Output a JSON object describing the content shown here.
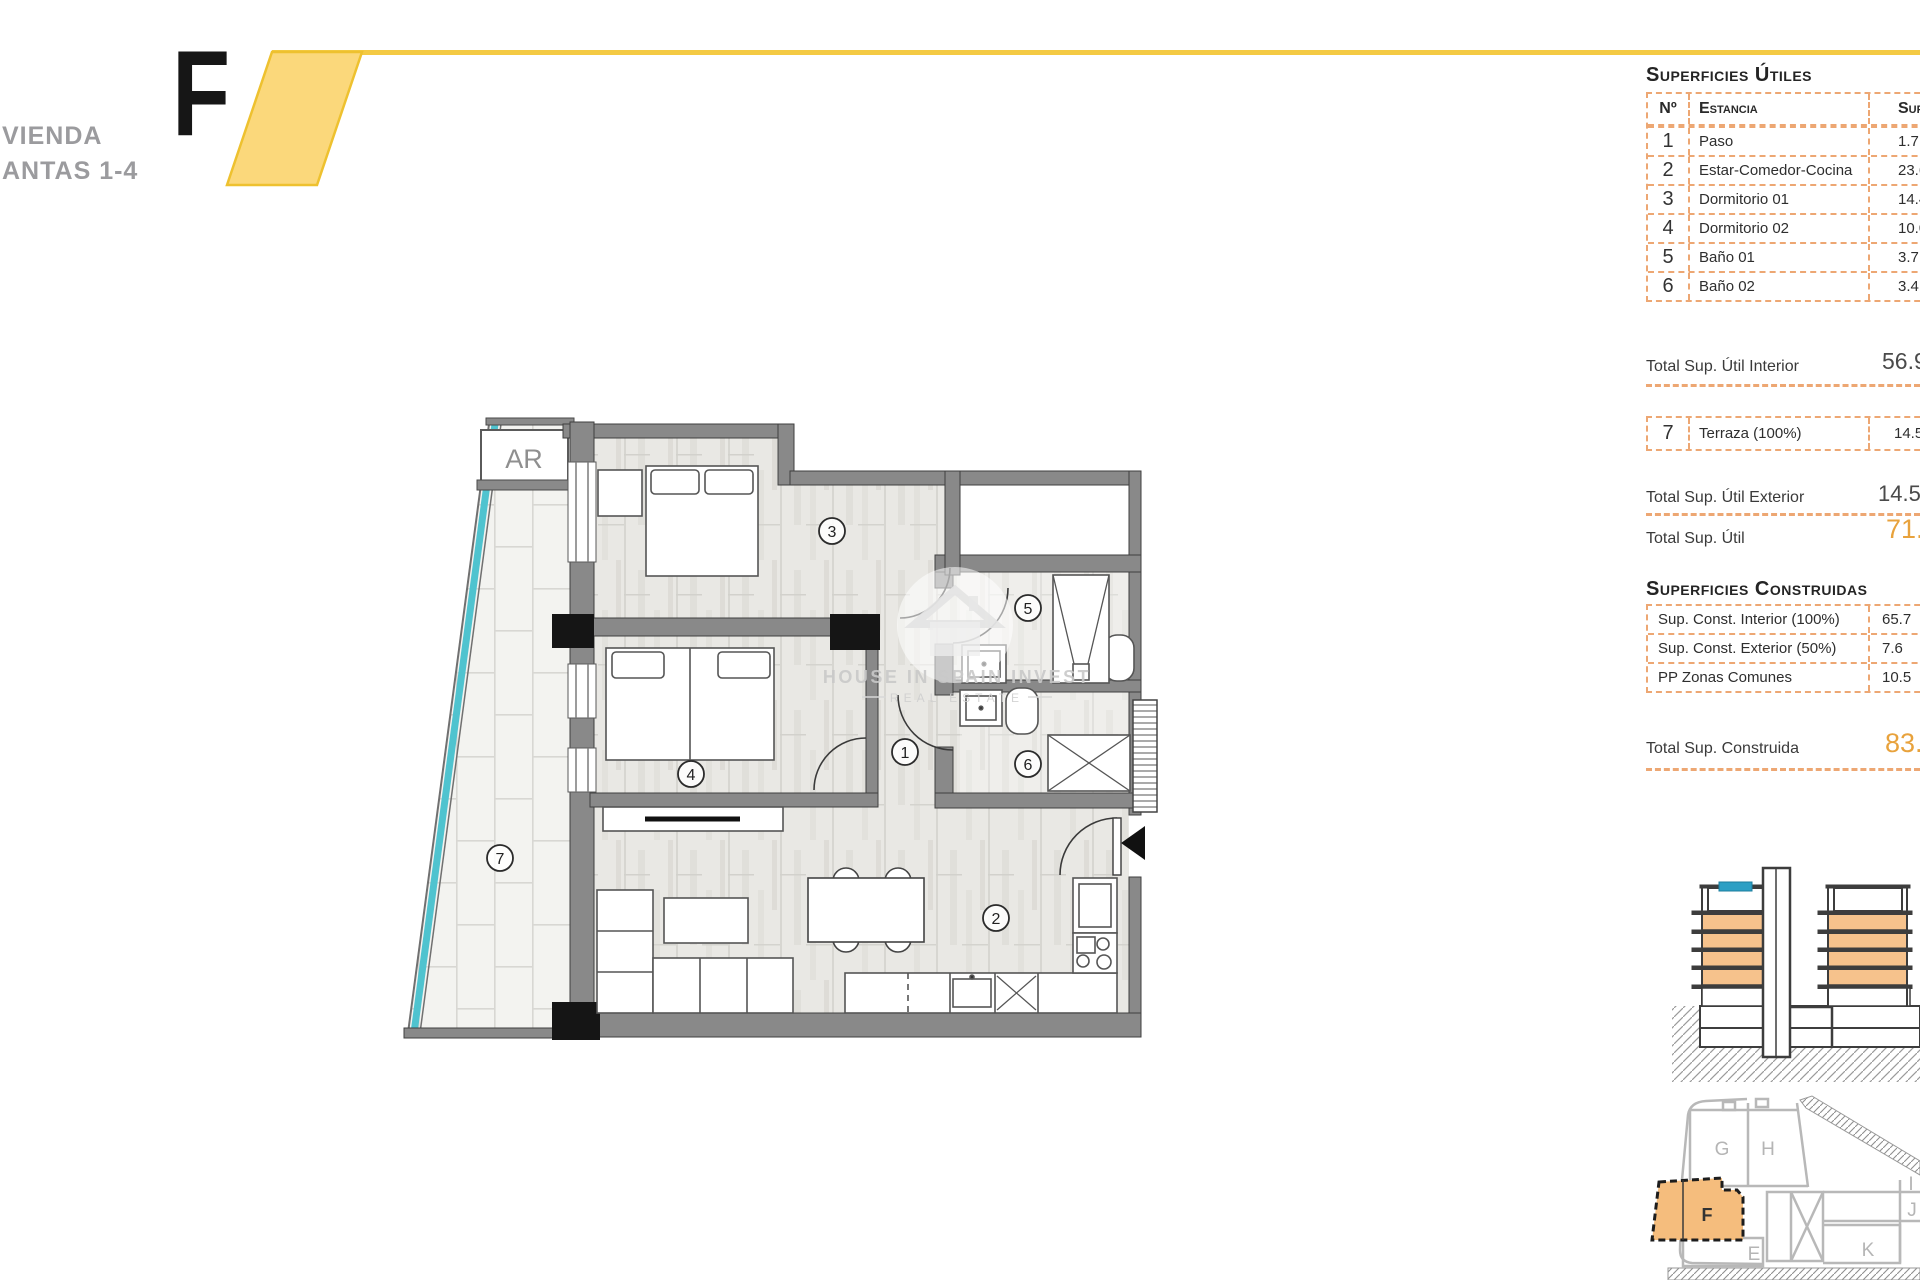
{
  "header": {
    "title_line1": "VIENDA",
    "title_line2": "ANTAS 1-4",
    "unit_letter": "F"
  },
  "colors": {
    "ribbon_yellow": "#fbd87b",
    "ribbon_outline": "#eec12f",
    "table_border_orange": "#eda773",
    "accent_orange_text": "#e8a23c",
    "wall_gray": "#898989",
    "glass_cyan": "#4fc3cf",
    "section_floor_orange": "#f6c28c",
    "site_unit_orange": "#f5bd7d"
  },
  "superficies_utiles": {
    "heading": "Superficies Útiles",
    "col_n": "Nº",
    "col_estancia": "Estancia",
    "col_sup": "Sup.",
    "rows": [
      {
        "n": "1",
        "name": "Paso",
        "value": "1.7"
      },
      {
        "n": "2",
        "name": "Estar-Comedor-Cocina",
        "value": "23.6"
      },
      {
        "n": "3",
        "name": "Dormitorio 01",
        "value": "14.4"
      },
      {
        "n": "4",
        "name": "Dormitorio 02",
        "value": "10.0"
      },
      {
        "n": "5",
        "name": "Baño 01",
        "value": "3.7"
      },
      {
        "n": "6",
        "name": "Baño 02",
        "value": "3.4"
      }
    ],
    "total_interior_label": "Total Sup. Útil Interior",
    "total_interior_value": "56.9",
    "terraza_row": {
      "n": "7",
      "name": "Terraza (100%)",
      "value": "14.5"
    },
    "total_exterior_label": "Total Sup. Útil Exterior",
    "total_exterior_value": "14.5",
    "total_util_label": "Total Sup. Útil",
    "total_util_value": "71."
  },
  "superficies_construidas": {
    "heading": "Superficies Construidas",
    "rows": [
      {
        "name": "Sup. Const. Interior (100%)",
        "value": "65.7"
      },
      {
        "name": "Sup. Const. Exterior (50%)",
        "value": "7.6"
      },
      {
        "name": "PP Zonas Comunes",
        "value": "10.5"
      }
    ],
    "total_label": "Total Sup. Construida",
    "total_value": "83."
  },
  "floor_plan": {
    "storage_label": "AR",
    "rooms": {
      "paso": "1",
      "estar": "2",
      "dorm1": "3",
      "dorm2": "4",
      "bano1": "5",
      "bano2": "6",
      "terraza": "7"
    },
    "watermark_line1": "HOUSE IN SPAIN INVEST",
    "watermark_line2": "REAL ESTATE"
  },
  "site_plan": {
    "labels": {
      "g": "G",
      "h": "H",
      "f": "F",
      "e": "E",
      "k": "K",
      "j": "J",
      "i": "I"
    }
  }
}
